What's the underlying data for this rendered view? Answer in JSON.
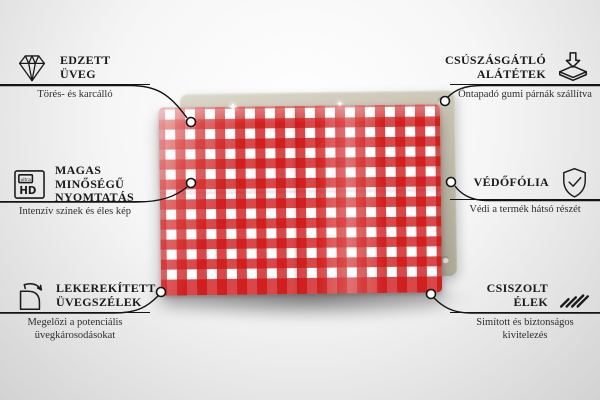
{
  "meta": {
    "description": "Annotated product infographic of a glass magnetic board with a red-white gingham pattern, feature callouts in Hungarian"
  },
  "features": {
    "left": [
      {
        "icon": "diamond-icon",
        "line1": "EDZETT",
        "line2": "ÜVEG",
        "subtitle": "Törés- és karcálló"
      },
      {
        "icon": "ultra-hd-icon",
        "line1": "MAGAS MINŐSÉGŰ",
        "line2": "NYOMTATÁS",
        "subtitle": "Intenzív színek és éles kép",
        "icon_text_top": "ultra",
        "icon_text_bottom": "HD"
      },
      {
        "icon": "rounded-corner-icon",
        "line1": "LEKEREKÍTETT",
        "line2": "ÜVEGSZÉLEK",
        "subtitle": "Megelőzi a potenciális üvegkárosodásokat"
      }
    ],
    "right": [
      {
        "icon": "anti-slip-pads-icon",
        "line1": "CSÚSZÁSGÁTLÓ",
        "line2": "ALÁTÉTEK",
        "subtitle": "Öntapadó gumi párnák szállítva"
      },
      {
        "icon": "shield-check-icon",
        "line1": "VÉDŐFÓLIA",
        "line2": "",
        "subtitle": "Védi a termék hátsó részét"
      },
      {
        "icon": "polished-edges-icon",
        "line1": "CSISZOLT",
        "line2": "ÉLEK",
        "subtitle": "Simított és biztonságos kivitelezés"
      }
    ]
  },
  "product": {
    "pattern": "red-white-gingham",
    "sparkle_glyph": "✦",
    "colors": {
      "gingham_red": "#d01f1f",
      "gingham_light_red": "#d94848",
      "back_panel": "#c6c1b0",
      "connector_line": "#141414",
      "background_top": "#ffffff",
      "background_bottom": "#d2d2d2"
    }
  }
}
